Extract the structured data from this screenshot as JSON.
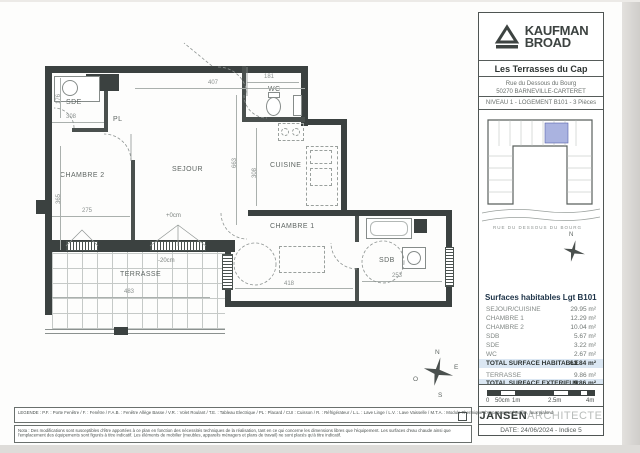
{
  "header": {
    "brand_line1": "KAUFMAN",
    "brand_line2": "BROAD",
    "project": "Les Terrasses du Cap",
    "address_line1": "Rue du Dessous du Bourg",
    "address_line2": "50270 BARNEVILLE-CARTERET",
    "level_info": "NIVEAU 1 - LOGEMENT B101 - 3 Pièces"
  },
  "key_plan": {
    "street_label": "RUE DU DESSOUS DU BOURG",
    "north_label": "N"
  },
  "plan": {
    "rooms": {
      "sde": "SDE",
      "pl": "PL",
      "wc": "WC",
      "chambre2": "CHAMBRE 2",
      "sejour": "SEJOUR",
      "cuisine": "CUISINE",
      "chambre1": "CHAMBRE 1",
      "sdb": "SDB",
      "terrasse": "TERRASSE"
    },
    "dims": {
      "top": "407",
      "wc_w": "181",
      "sde_w": "308",
      "sde_h": "176",
      "ch2_h": "365",
      "ch2_w": "275",
      "sejour_h": "663",
      "cuisine_h": "308",
      "ch1_w": "418",
      "sdb_w": "253",
      "terrasse_w": "483"
    },
    "annotations": {
      "level0": "+0cm",
      "level20": "-20cm"
    },
    "compass": {
      "n": "N",
      "e": "E",
      "s": "S",
      "o": "O"
    }
  },
  "surfaces": {
    "title": "Surfaces habitables Lgt B101",
    "rows": [
      {
        "label": "SEJOUR/CUISINE",
        "value": "29.95 m²"
      },
      {
        "label": "CHAMBRE 1",
        "value": "12.29 m²"
      },
      {
        "label": "CHAMBRE 2",
        "value": "10.04 m²"
      },
      {
        "label": "SDB",
        "value": "5.67 m²"
      },
      {
        "label": "SDE",
        "value": "3.22 m²"
      },
      {
        "label": "WC",
        "value": "2.67 m²"
      }
    ],
    "total_habitable": {
      "label": "TOTAL SURFACE HABITABLE",
      "value": "63.84 m²"
    },
    "terrasse_row": {
      "label": "TERRASSE",
      "value": "9.86 m²"
    },
    "total_exterieur": {
      "label": "TOTAL SURFACE EXTERIEUR",
      "value": "9.86 m²"
    }
  },
  "scale_bar": {
    "labels": [
      "0",
      "50cm",
      "1m",
      "2.5m",
      "4m"
    ]
  },
  "architect": {
    "name_bold": "JANSEN",
    "name_light": "ARCHITECTE",
    "date_line": "DATE: 24/06/2024 - Indice 5"
  },
  "legend": {
    "text": "LEGENDE : P.F. : Porte Fenêtre / F. : Fenêtre / F.A.B. : Fenêtre Allège Basse / V.R. : Volet Roulant / T.E. : Tableau Electrique / PL : Placard / CUI : Cuisson / R. : Réfrigérateur / L.L. : Lave Linge / L.V. : Lave Vaisselle / M.T.A. : Module Thermique d'Appartement / Soffite, faux plafond"
  },
  "note": {
    "text": "Nota : Des modifications sont susceptibles d'être apportées à ce plan en fonction des nécessités techniques de la réalisation, tant en ce qui concerne les dimensions libres que l'équipement. Les surfaces d'eau chaude ainsi que l'emplacement des équipements sont figurés à titre indicatif. Les éléments de mobilier (meubles, appareils ménagers et plans de travail) ne sont placés qu'à titre indicatif."
  }
}
